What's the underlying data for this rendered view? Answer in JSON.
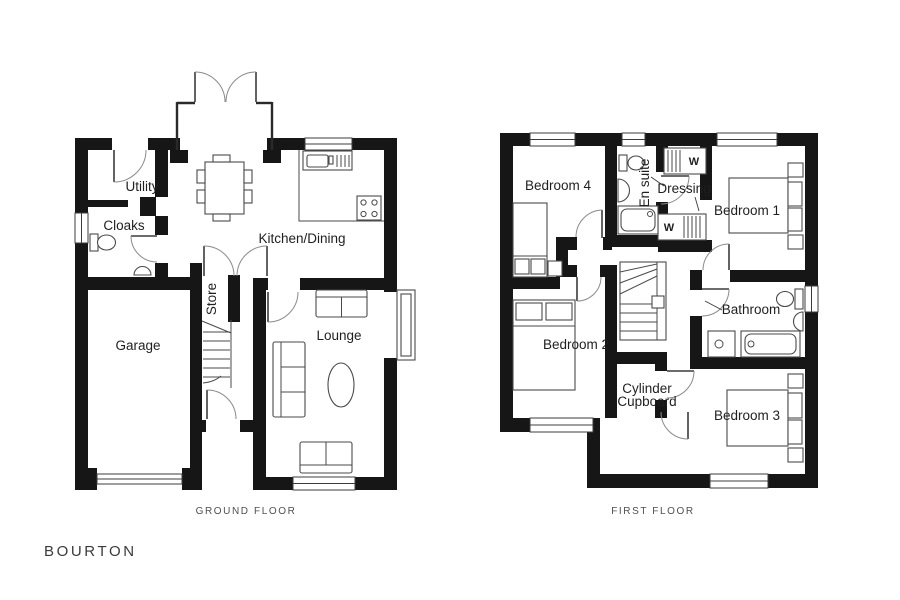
{
  "title": "BOURTON",
  "ground_floor": {
    "caption": "GROUND FLOOR",
    "rooms": {
      "utility": "Utility",
      "cloaks": "Cloaks",
      "garage": "Garage",
      "store": "Store",
      "kitchen_dining": "Kitchen/Dining",
      "lounge": "Lounge"
    }
  },
  "first_floor": {
    "caption": "FIRST FLOOR",
    "rooms": {
      "bedroom4": "Bedroom 4",
      "en_suite": "En suite",
      "dressing": "Dressing",
      "bedroom1": "Bedroom 1",
      "bedroom2": "Bedroom 2",
      "bathroom": "Bathroom",
      "cylinder_cupboard_line1": "Cylinder",
      "cylinder_cupboard_line2": "Cupboard",
      "bedroom3": "Bedroom 3"
    },
    "wardrobe_marker": "W"
  },
  "colors": {
    "background": "#ffffff",
    "wall": "#161616",
    "furniture_line": "#4a4a4a",
    "door_line": "#8a8a8a",
    "text": "#1f1f1f",
    "caption_text": "#4f4f4f"
  }
}
